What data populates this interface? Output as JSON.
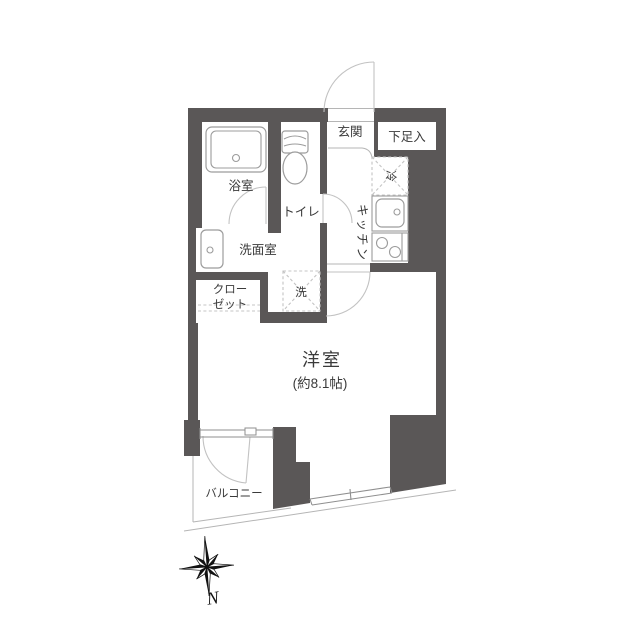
{
  "diagram_type": "japanese-apartment-floor-plan",
  "colors": {
    "wall": "#5a5757",
    "background": "#ffffff",
    "fixture_line": "#9c9c9c",
    "door_arc": "#c2c2c2",
    "window_line": "#8f8f8f",
    "text": "#3a3a3a"
  },
  "rooms": {
    "entrance": {
      "label": "玄関"
    },
    "shoe_storage": {
      "label": "下足入"
    },
    "refrigerator": {
      "label": "冷"
    },
    "kitchen": {
      "label": "キッチン"
    },
    "bathroom": {
      "label": "浴室"
    },
    "toilet": {
      "label": "トイレ"
    },
    "washroom": {
      "label": "洗面室"
    },
    "closet": {
      "label_line1": "クロー",
      "label_line2": "ゼット"
    },
    "washer": {
      "label": "洗"
    },
    "main_room": {
      "label": "洋室",
      "size": "(約8.1帖)"
    },
    "balcony": {
      "label": "バルコニー"
    }
  },
  "compass": {
    "north_label": "N"
  }
}
